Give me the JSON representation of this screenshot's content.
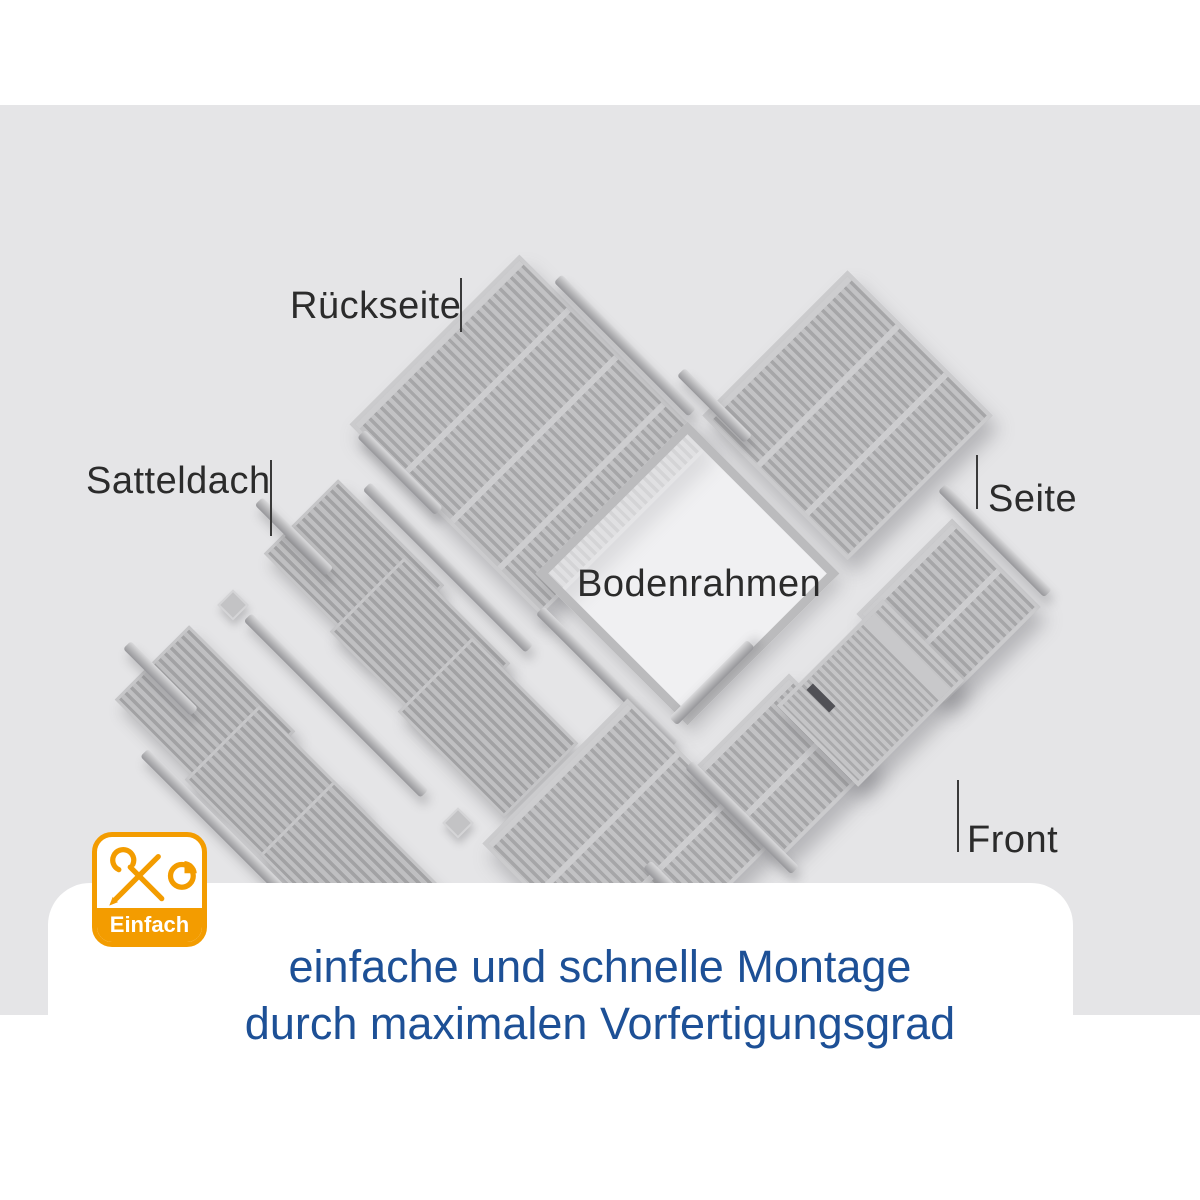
{
  "labels": {
    "rueckseite": "Rückseite",
    "satteldach": "Satteldach",
    "bodenrahmen": "Bodenrahmen",
    "seite_right": "Seite",
    "front": "Front",
    "seite_bottom": "Seite"
  },
  "badge": {
    "label": "Einfach",
    "icon": "wrench-pencil-pie-chart-icon",
    "color": "#f39c00"
  },
  "caption": {
    "line1": "einfache und schnelle Montage",
    "line2": "durch maximalen Vorfertigungsgrad",
    "color": "#1d5096"
  },
  "colors": {
    "stage_background": "#e5e5e7",
    "panel_gray": "#b4b4b6",
    "label_text": "#2b2b2b"
  }
}
